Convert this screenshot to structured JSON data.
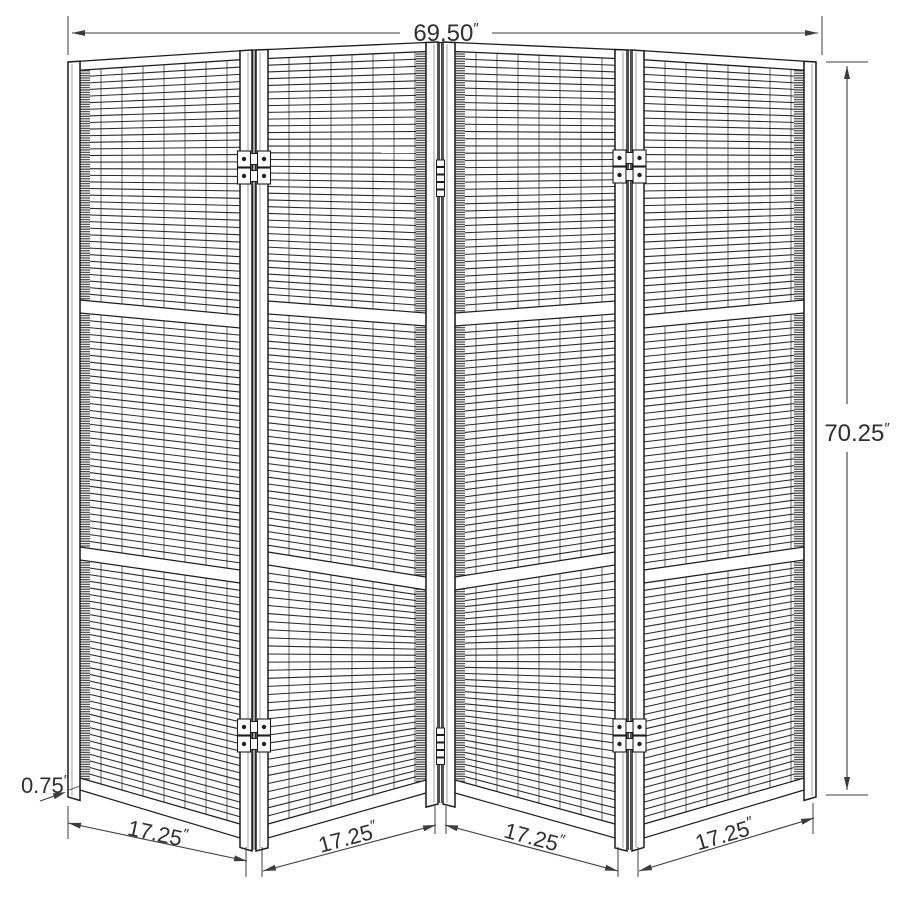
{
  "diagram": {
    "kind": "four-panel folding screen dimension drawing",
    "dimensions": {
      "width": {
        "value": "69.50",
        "unit": "″"
      },
      "height": {
        "value": "70.25",
        "unit": "″"
      },
      "thickness": {
        "value": "0.75",
        "unit": "″"
      },
      "panel_widths": [
        {
          "value": "17.25",
          "unit": "″"
        },
        {
          "value": "17.25",
          "unit": "″"
        },
        {
          "value": "17.25",
          "unit": "″"
        },
        {
          "value": "17.25",
          "unit": "″"
        }
      ]
    },
    "colors": {
      "background": "#ffffff",
      "line": "#1c1c1c",
      "dimension_line": "#3c3c3c",
      "text": "#2e2e2e"
    }
  }
}
